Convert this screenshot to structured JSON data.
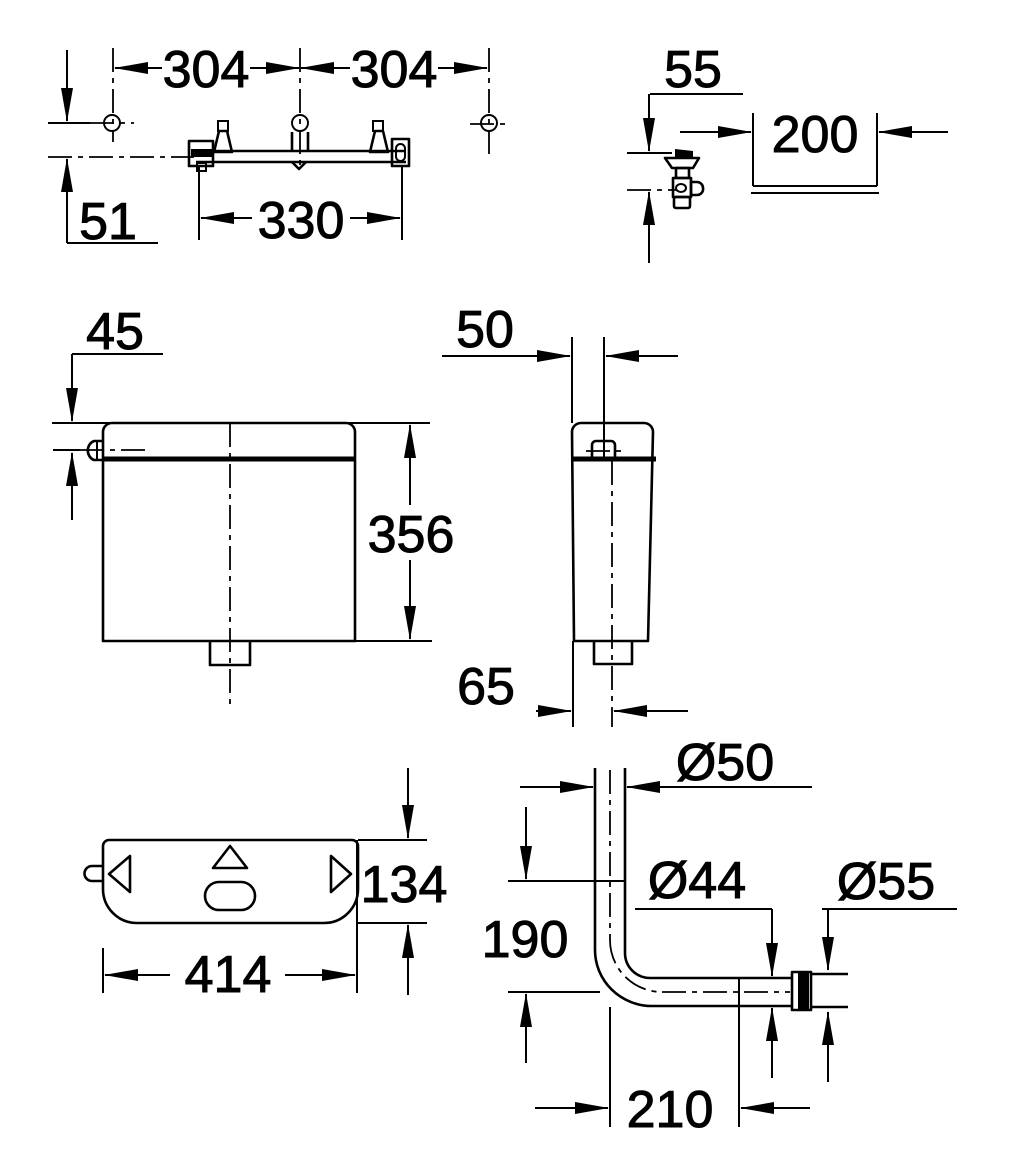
{
  "figures": {
    "mounting_top_view": {
      "dims": {
        "hole_spacing_left": "304",
        "hole_spacing_right": "304",
        "rail_offset": "51",
        "bracket_width": "330"
      }
    },
    "angle_valve": {
      "dims": {
        "height_offset": "55",
        "recess_width": "200"
      }
    },
    "cistern_front": {
      "dims": {
        "lever_from_top": "45",
        "height": "356"
      }
    },
    "cistern_side": {
      "dims": {
        "lever_from_front": "50",
        "outlet_from_front": "65"
      }
    },
    "cistern_plan": {
      "dims": {
        "depth": "134",
        "width": "414"
      }
    },
    "flush_pipe": {
      "dims": {
        "outer_diameter": "Ø50",
        "pipe_diameter": "Ø44",
        "connector_diameter": "Ø55",
        "vertical_leg": "190",
        "horizontal_leg": "210"
      }
    },
    "colors": {
      "line": "#000000",
      "background": "#ffffff"
    }
  }
}
